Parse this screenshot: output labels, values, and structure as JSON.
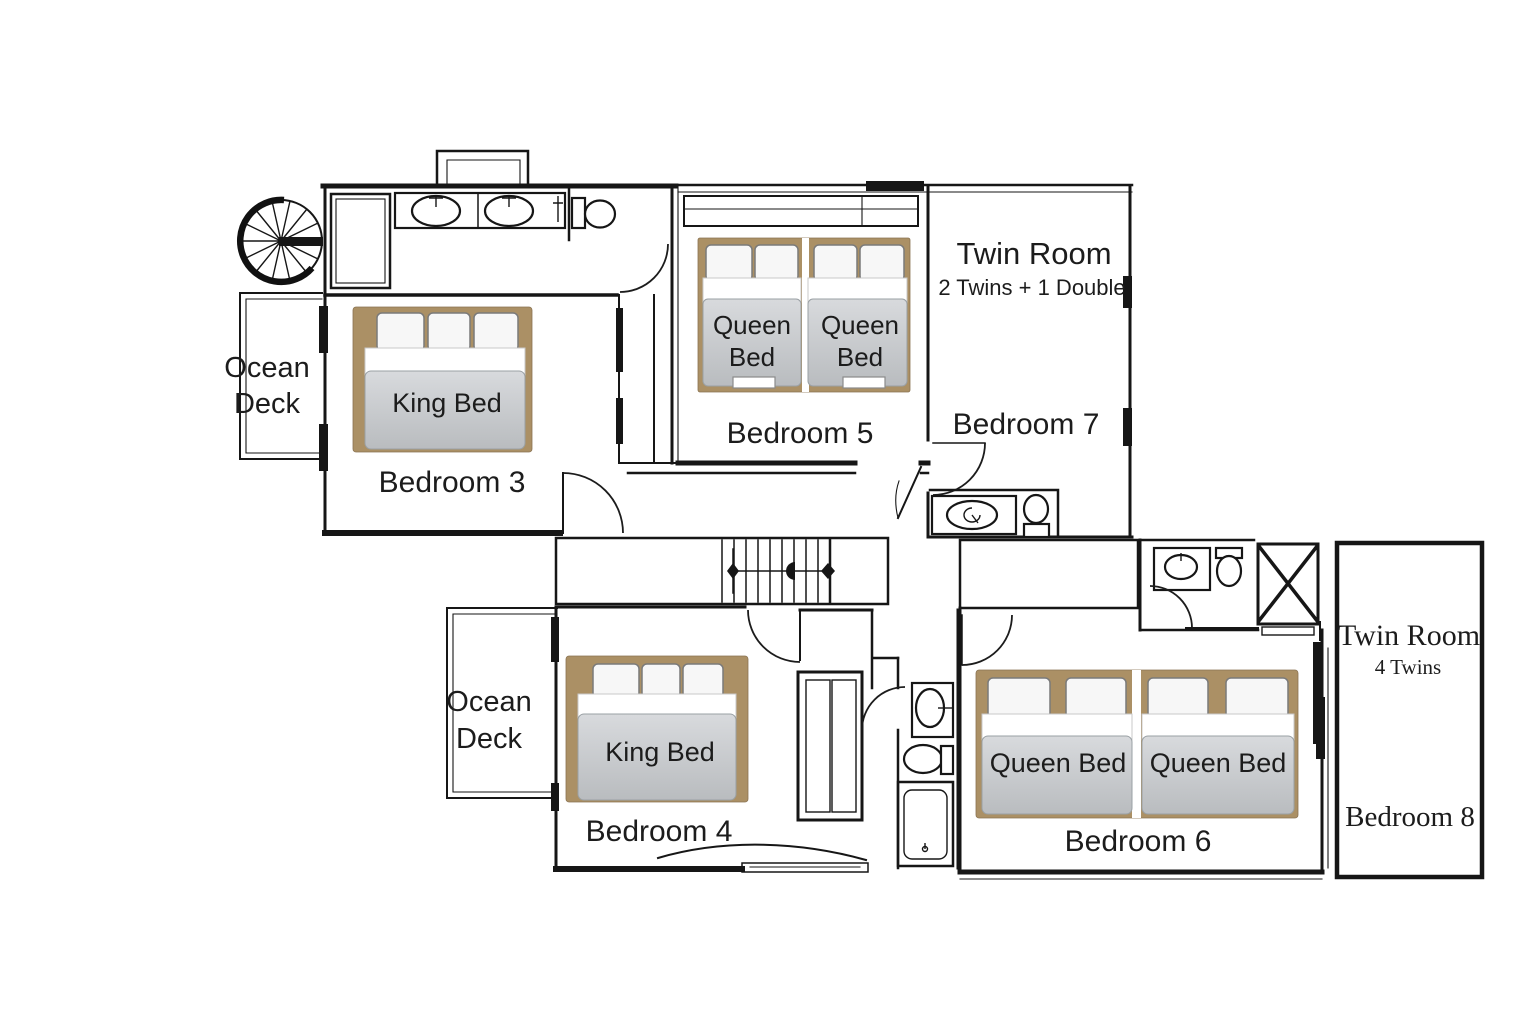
{
  "plan": {
    "colors": {
      "wall": "#161616",
      "bed_frame": "#ab9065",
      "mattress_top": "#d8dadd",
      "mattress_bottom": "#b9bcbf",
      "pillow": "#f7f7f7",
      "background": "#ffffff"
    },
    "decks": {
      "upper": {
        "line1": "Ocean",
        "line2": "Deck"
      },
      "lower": {
        "line1": "Ocean",
        "line2": "Deck"
      }
    },
    "rooms": {
      "bedroom3": {
        "name": "Bedroom 3",
        "bed_label": "King Bed"
      },
      "bedroom4": {
        "name": "Bedroom 4",
        "bed_label": "King Bed"
      },
      "bedroom5": {
        "name": "Bedroom 5",
        "bed1": {
          "line1": "Queen",
          "line2": "Bed"
        },
        "bed2": {
          "line1": "Queen",
          "line2": "Bed"
        }
      },
      "bedroom6": {
        "name": "Bedroom 6",
        "bed1_label": "Queen Bed",
        "bed2_label": "Queen Bed"
      },
      "bedroom7": {
        "name": "Bedroom 7",
        "room_type": "Twin Room",
        "room_type_detail": "2 Twins + 1 Double"
      },
      "bedroom8": {
        "name": "Bedroom 8",
        "room_type": "Twin Room",
        "room_type_detail": "4 Twins"
      }
    }
  }
}
